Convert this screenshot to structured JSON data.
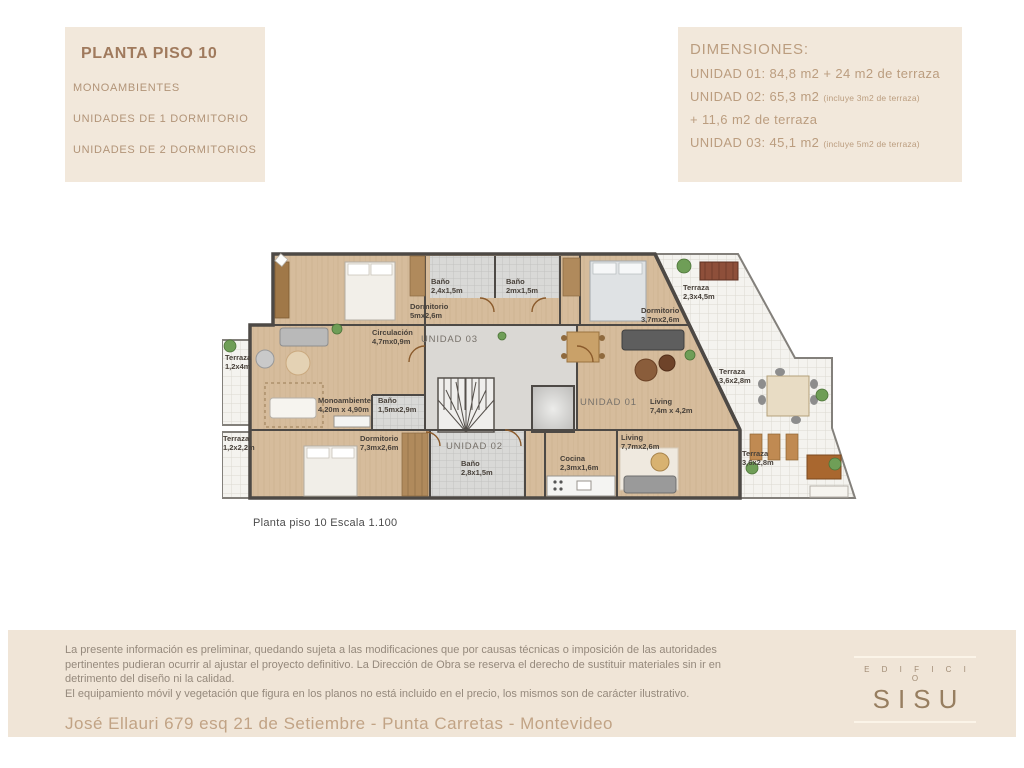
{
  "legend_box": {
    "title": "PLANTA PISO 10",
    "items": [
      {
        "label": "MONOAMBIENTES"
      },
      {
        "label": "UNIDADES DE 1 DORMITORIO"
      },
      {
        "label": "UNIDADES DE 2 DORMITORIOS"
      }
    ]
  },
  "dimensions_box": {
    "title": "DIMENSIONES:",
    "lines": [
      {
        "main": "UNIDAD 01: 84,8 m2 + 24 m2 de terraza",
        "small": ""
      },
      {
        "main": "UNIDAD 02: 65,3 m2",
        "small": "(incluye 3m2 de terraza)"
      },
      {
        "main": "+ 11,6 m2 de terraza",
        "small": ""
      },
      {
        "main": "UNIDAD 03: 45,1 m2",
        "small": "(incluye 5m2 de terraza)"
      }
    ]
  },
  "plan": {
    "caption": "Planta piso 10 Escala 1.100",
    "unit_labels": [
      {
        "label": "UNIDAD 03"
      },
      {
        "label": "UNIDAD 01"
      },
      {
        "label": "UNIDAD 02"
      }
    ],
    "rooms": [
      {
        "name": "Baño",
        "dims": "2,4x1,5m"
      },
      {
        "name": "Baño",
        "dims": "2mx1,5m"
      },
      {
        "name": "Dormitorio",
        "dims": "5mx2,6m"
      },
      {
        "name": "Dormitorio",
        "dims": "3,7mx2,6m"
      },
      {
        "name": "Terraza",
        "dims": "2,3x4,5m"
      },
      {
        "name": "Circulación",
        "dims": "4,7mx0,9m"
      },
      {
        "name": "Monoambiente",
        "dims": "4,20m x 4,90m"
      },
      {
        "name": "Baño",
        "dims": "1,5mx2,9m"
      },
      {
        "name": "Terraza",
        "dims": "1,2x4m"
      },
      {
        "name": "Terraza",
        "dims": "1,2x2,2m"
      },
      {
        "name": "Dormitorio",
        "dims": "7,3mx2,6m"
      },
      {
        "name": "Baño",
        "dims": "2,8x1,5m"
      },
      {
        "name": "Cocina",
        "dims": "2,3mx1,6m"
      },
      {
        "name": "Living",
        "dims": "7,7mx2,6m"
      },
      {
        "name": "Living",
        "dims": "7,4m x 4,2m"
      },
      {
        "name": "Terraza",
        "dims": "3,6x2,8m"
      },
      {
        "name": "Terraza",
        "dims": "3,6x2,8m"
      }
    ]
  },
  "footer": {
    "disclaimer_1": "La presente información es preliminar, quedando sujeta a las modificaciones que por causas técnicas o imposición de las autoridades pertinentes pudieran ocurrir al ajustar el proyecto definitivo. La Dirección de Obra se reserva el derecho de sustituir materiales sin ir en detrimento del diseño ni la calidad.",
    "disclaimer_2": "El equipamiento móvil y vegetación que figura en los planos no está incluido en el precio, los mismos son de carácter ilustrativo.",
    "address": "José Ellauri 679 esq 21 de Setiembre - Punta Carretas - Montevideo",
    "logo_top": "E D I F I C I O",
    "logo_main": "SISU"
  },
  "colors": {
    "box_bg": "#f2e8db",
    "footer_bg": "#f0e5d7",
    "title_brown": "#a07a5d",
    "text_brown": "#bb9d7f",
    "address_brown": "#c1a385",
    "wall": "#4d4945",
    "wood_floor": "#d6bc9c",
    "terrace_tile": "#f4f3ef",
    "bath_tile": "#d9d9d7",
    "core_gray": "#dad8d4"
  }
}
